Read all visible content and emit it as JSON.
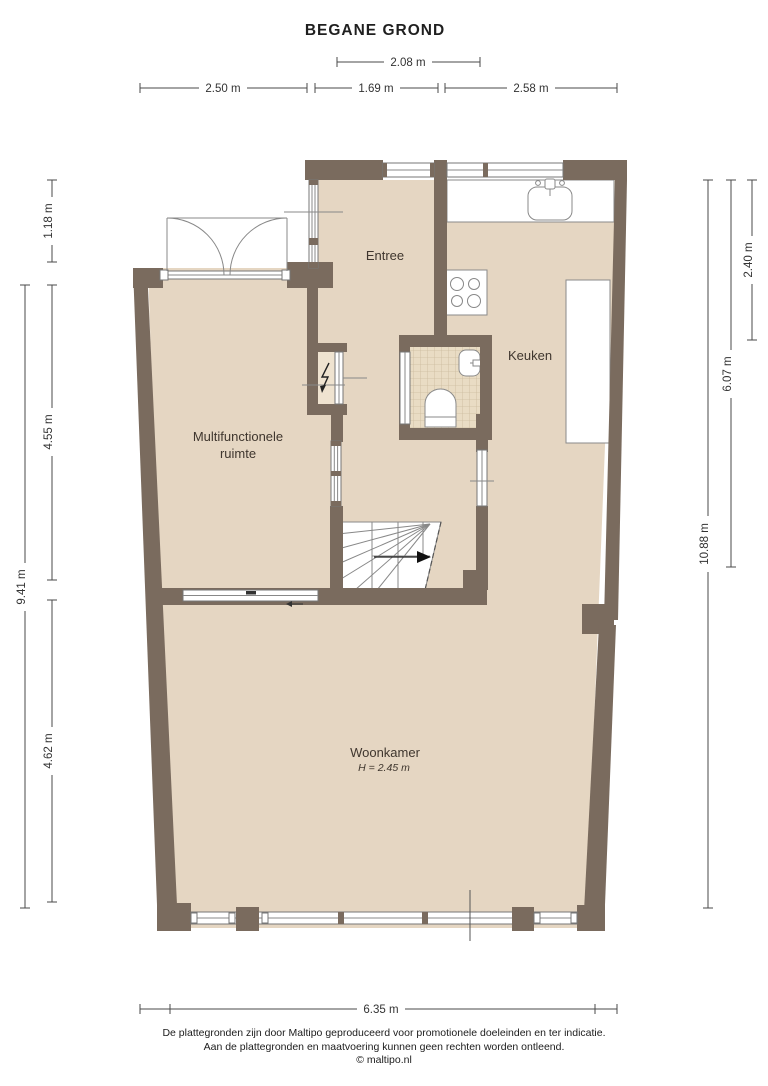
{
  "title": "BEGANE GROND",
  "rooms": {
    "entree": "Entree",
    "keuken": "Keuken",
    "multifunctionele_line1": "Multifunctionele",
    "multifunctionele_line2": "ruimte",
    "woonkamer": "Woonkamer",
    "woonkamer_ceiling_height": "H = 2.45 m"
  },
  "dimensions": {
    "top_width": "2.08 m",
    "upper_left_width": "2.50 m",
    "upper_middle_width": "1.69 m",
    "upper_right_width": "2.58 m",
    "left_top_height": "1.18 m",
    "left_middle_height": "4.55 m",
    "left_outer_height": "9.41 m",
    "left_bottom_height": "4.62 m",
    "right_top_height": "2.40 m",
    "right_middle_height": "6.07 m",
    "right_outer_height": "10.88 m",
    "bottom_width": "6.35 m"
  },
  "footer": {
    "line1": "De plattegronden zijn door Maltipo geproduceerd voor promotionele doeleinden en ter indicatie.",
    "line2": "Aan de plattegronden en maatvoering kunnen geen rechten worden ontleend.",
    "line3": "© maltipo.nl"
  },
  "colors": {
    "wall": "#7a6b5e",
    "floor": "#e5d6c2",
    "wc_tile": "#e9dcc4",
    "dimension_line": "#4a4a4a"
  }
}
